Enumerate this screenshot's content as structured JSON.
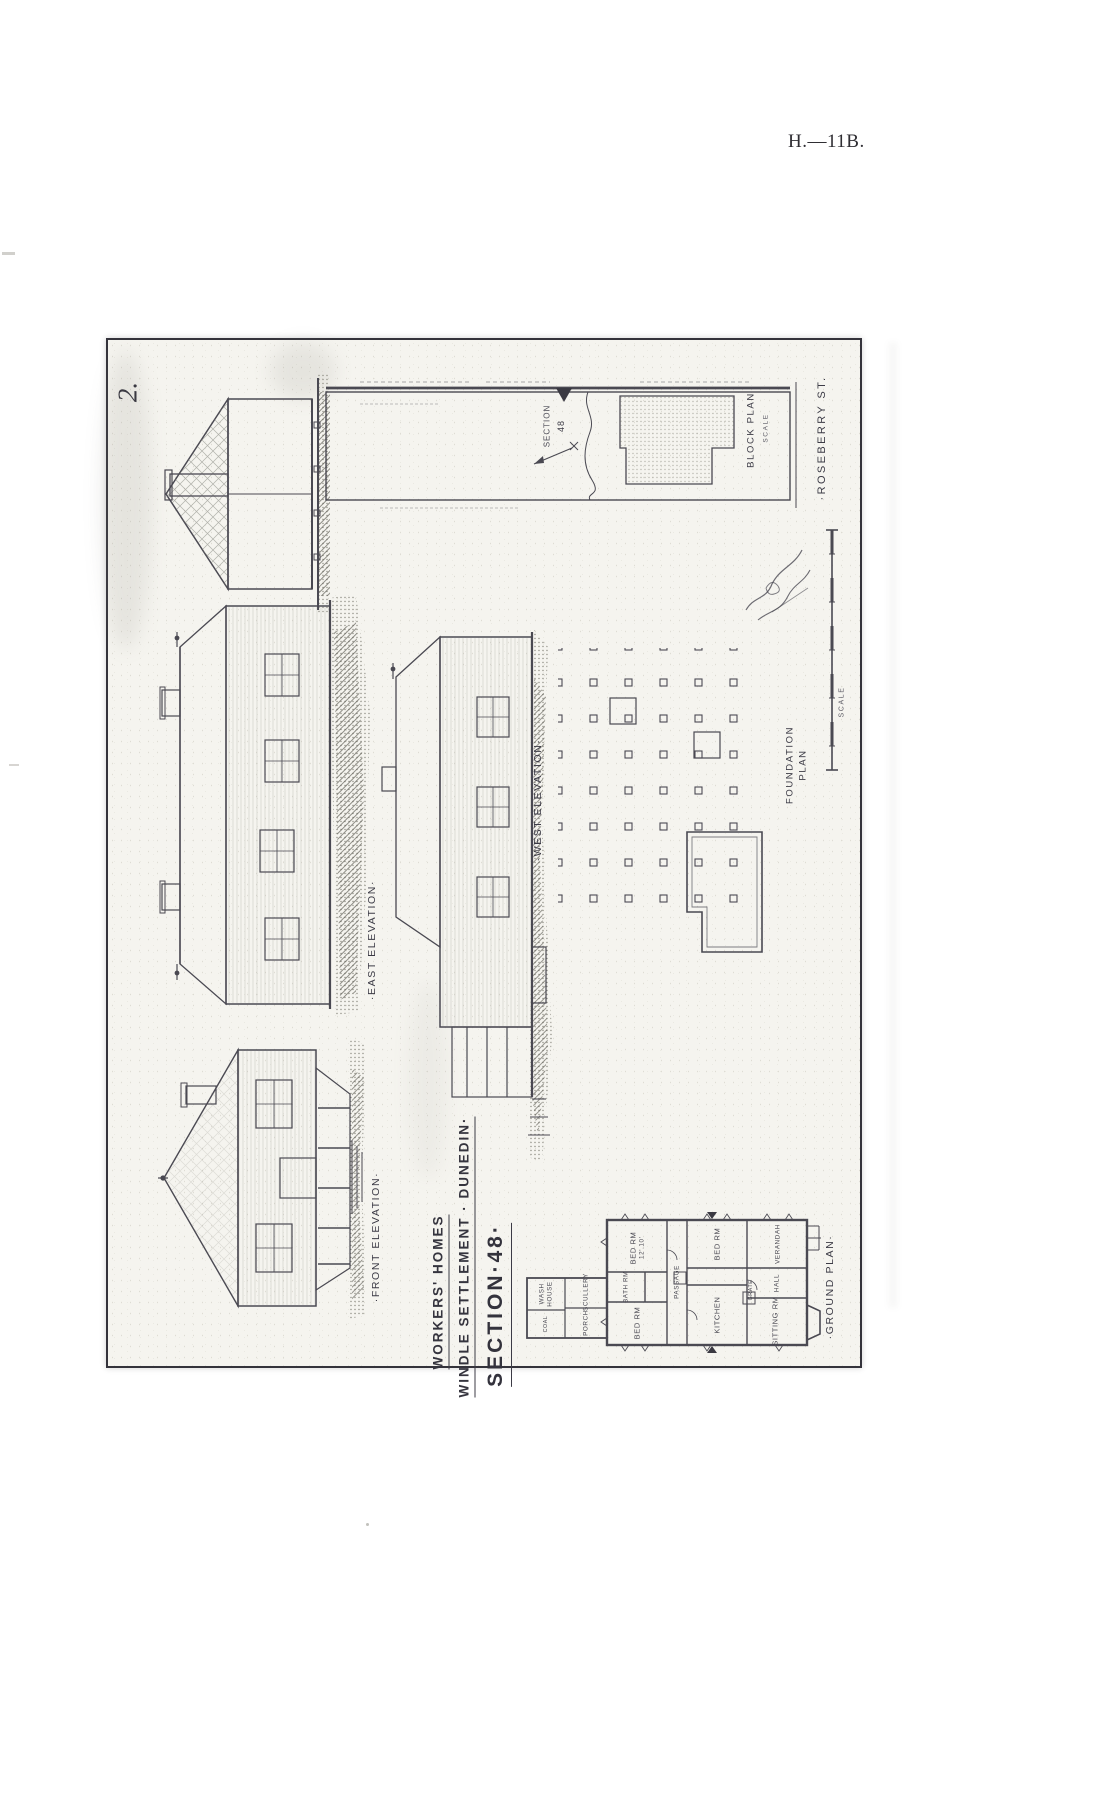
{
  "page": {
    "header_right": "H.—11B.",
    "plate_number": "2."
  },
  "title_block": {
    "line1": "WORKERS' HOMES",
    "line2": "WINDLE SETTLEMENT · DUNEDIN·",
    "line3": "SECTION·48·"
  },
  "labels": {
    "east_elevation": "·EAST ELEVATION·",
    "west_elevation": "·WEST ELEVATION·",
    "front_elevation": "·FRONT ELEVATION·",
    "block_plan": "BLOCK PLAN",
    "block_plan_scale": "SCALE",
    "lot_word": "SECTION",
    "lot_number": "48",
    "street": "·ROSEBERRY ST.",
    "foundation_word1": "FOUNDATION",
    "foundation_word2": "PLAN",
    "ground_plan": "·GROUND PLAN·",
    "scale_bar": "SCALE"
  },
  "rooms": {
    "bed1": {
      "name": "BED RM",
      "size": "12'.10'"
    },
    "bed2": {
      "name": "BED RM"
    },
    "bed3": {
      "name": "BED RM"
    },
    "bath": {
      "name": "BATH RM"
    },
    "passage": {
      "name": "PASSAGE"
    },
    "kitchen": {
      "name": "KITCHEN"
    },
    "sitting": {
      "name": "SITTING RM"
    },
    "verandah": {
      "name": "VERANDAH"
    },
    "hall": {
      "name": "HALL"
    },
    "grate": {
      "name": "GRATE"
    },
    "scullery": {
      "name": "SCULLERY"
    },
    "washhouse": {
      "w1": "WASH",
      "w2": "HOUSE"
    },
    "coal": {
      "name": "COAL"
    },
    "porch": {
      "name": "PORCH"
    }
  }
}
